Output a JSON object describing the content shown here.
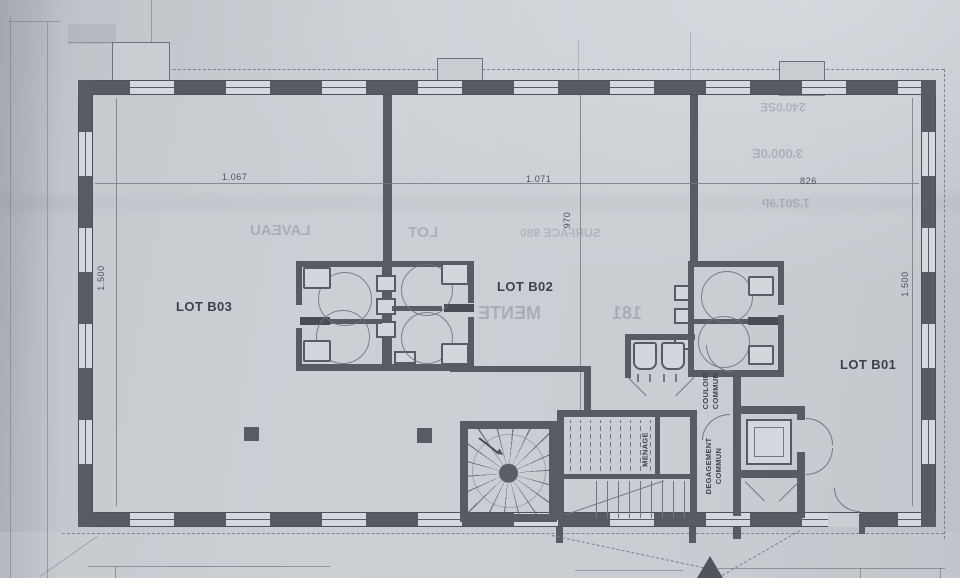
{
  "colors": {
    "paper": "#c6cacf",
    "ink": "#575c64",
    "label_ink": "#3d424a"
  },
  "plan": {
    "lots": {
      "b03": "LOT B03",
      "b02": "LOT B02",
      "b01": "LOT B01"
    },
    "rooms": {
      "couloir": "COULOIR\nCOMMUN",
      "degagement": "DEGAGEMENT\nCOMMUN",
      "menage": "MENAGE"
    },
    "dims": {
      "top_left": "1.067",
      "top_mid": "1.071",
      "top_right": "826",
      "left": "1.500",
      "right": "1.500",
      "mid": "970"
    },
    "bleedthrough": {
      "t1": "LAVEAU",
      "t2": "LOT",
      "t3": "SURFACE 980",
      "t4": "MENTE",
      "t5": "181",
      "t6": "240'0SE",
      "t7": "3'000'0E",
      "t8": "1'S01'9b"
    }
  }
}
